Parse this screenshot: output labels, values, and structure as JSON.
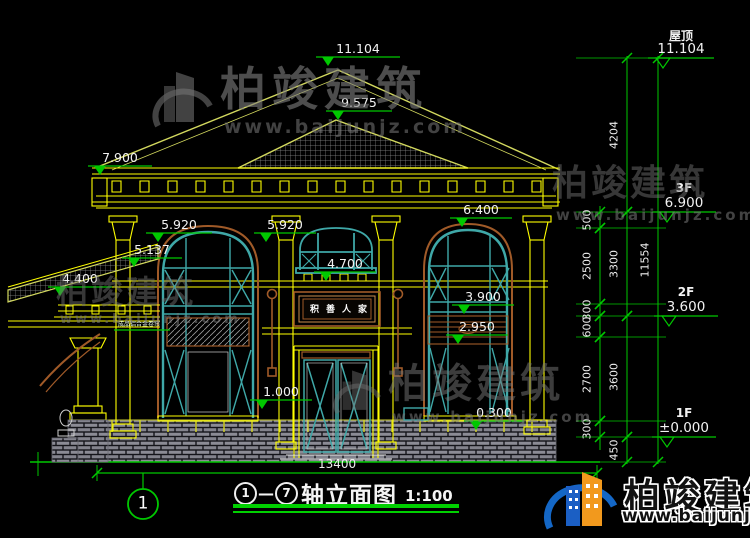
{
  "drawing_title": {
    "axis_start": "1",
    "axis_end": "7",
    "dash": "—",
    "name": "轴立面图",
    "scale": "1:100"
  },
  "watermark": {
    "brand": "柏竣建筑",
    "url": "www.baijunjz.com"
  },
  "plaque": {
    "text": "积善人家"
  },
  "annotation": {
    "text": "成品铝合金卷帘",
    "x": 118,
    "y": 319,
    "lx1": 114,
    "lx2": 170,
    "ly": 330
  },
  "levels_in_drawing": [
    {
      "label": "11.104",
      "x1": 316,
      "x2": 400,
      "y": 57
    },
    {
      "label": "9.575",
      "x1": 326,
      "x2": 392,
      "y": 111
    },
    {
      "label": "7.900",
      "x1": 88,
      "x2": 152,
      "y": 166
    },
    {
      "label": "5.920",
      "x1": 146,
      "x2": 212,
      "y": 233
    },
    {
      "label": "5.920",
      "x1": 254,
      "x2": 316,
      "y": 233
    },
    {
      "label": "6.400",
      "x1": 450,
      "x2": 512,
      "y": 218
    },
    {
      "label": "5.137",
      "x1": 122,
      "x2": 182,
      "y": 258
    },
    {
      "label": "4.400",
      "x1": 48,
      "x2": 112,
      "y": 287
    },
    {
      "label": "4.700",
      "x1": 314,
      "x2": 376,
      "y": 272
    },
    {
      "label": "3.900",
      "x1": 452,
      "x2": 514,
      "y": 305
    },
    {
      "label": "2.950",
      "x1": 446,
      "x2": 508,
      "y": 335
    },
    {
      "label": "1.000",
      "x1": 250,
      "x2": 312,
      "y": 400
    },
    {
      "label": "0.300",
      "x1": 464,
      "x2": 524,
      "y": 421
    }
  ],
  "floor_levels": [
    {
      "floor": "屋顶",
      "value": "11.104",
      "x1": 648,
      "x2": 714,
      "y": 58
    },
    {
      "floor": "3F",
      "value": "6.900",
      "x1": 652,
      "x2": 716,
      "y": 212
    },
    {
      "floor": "2F",
      "value": "3.600",
      "x1": 654,
      "x2": 718,
      "y": 316
    },
    {
      "floor": "1F",
      "value": "±0.000",
      "x1": 652,
      "x2": 716,
      "y": 437
    }
  ],
  "dim_chains": [
    {
      "x": 600,
      "y1": 206,
      "y2": 450,
      "segments": [
        {
          "label": "500",
          "y1": 212,
          "y2": 228
        },
        {
          "label": "2500",
          "y1": 228,
          "y2": 304
        },
        {
          "label": "300",
          "y1": 304,
          "y2": 316
        },
        {
          "label": "600",
          "y1": 316,
          "y2": 337
        },
        {
          "label": "2700",
          "y1": 337,
          "y2": 421
        },
        {
          "label": "300",
          "y1": 421,
          "y2": 437
        }
      ]
    },
    {
      "x": 627,
      "y1": 56,
      "y2": 464,
      "segments": [
        {
          "label": "4204",
          "y1": 58,
          "y2": 212
        },
        {
          "label": "3300",
          "y1": 212,
          "y2": 316
        },
        {
          "label": "3600",
          "y1": 316,
          "y2": 437
        },
        {
          "label": "450",
          "y1": 437,
          "y2": 462
        }
      ]
    },
    {
      "x": 658,
      "y1": 56,
      "y2": 464,
      "segments": [
        {
          "label": "11554",
          "y1": 58,
          "y2": 462
        }
      ]
    }
  ],
  "bottom_dimension": {
    "label": "13400",
    "x1": 97,
    "x2": 597,
    "y": 473,
    "tx": 318,
    "ty": 457
  },
  "axis_bubble": {
    "label": "1",
    "cx": 143,
    "cy": 504,
    "r": 15,
    "leader_x": 143,
    "leader_y1": 473,
    "leader_y2": 489
  },
  "colors": {
    "dimension_green": "#00c800",
    "line_yellow": "#ffff00",
    "roof_olive": "#d2d85e",
    "frame_teal": "#3fa8a8",
    "trim_brown": "#a05a28",
    "text_white": "#f2f2f2",
    "underline_green": "#00d000",
    "logo_blue": "#1467c6",
    "logo_orange": "#f2991d"
  }
}
